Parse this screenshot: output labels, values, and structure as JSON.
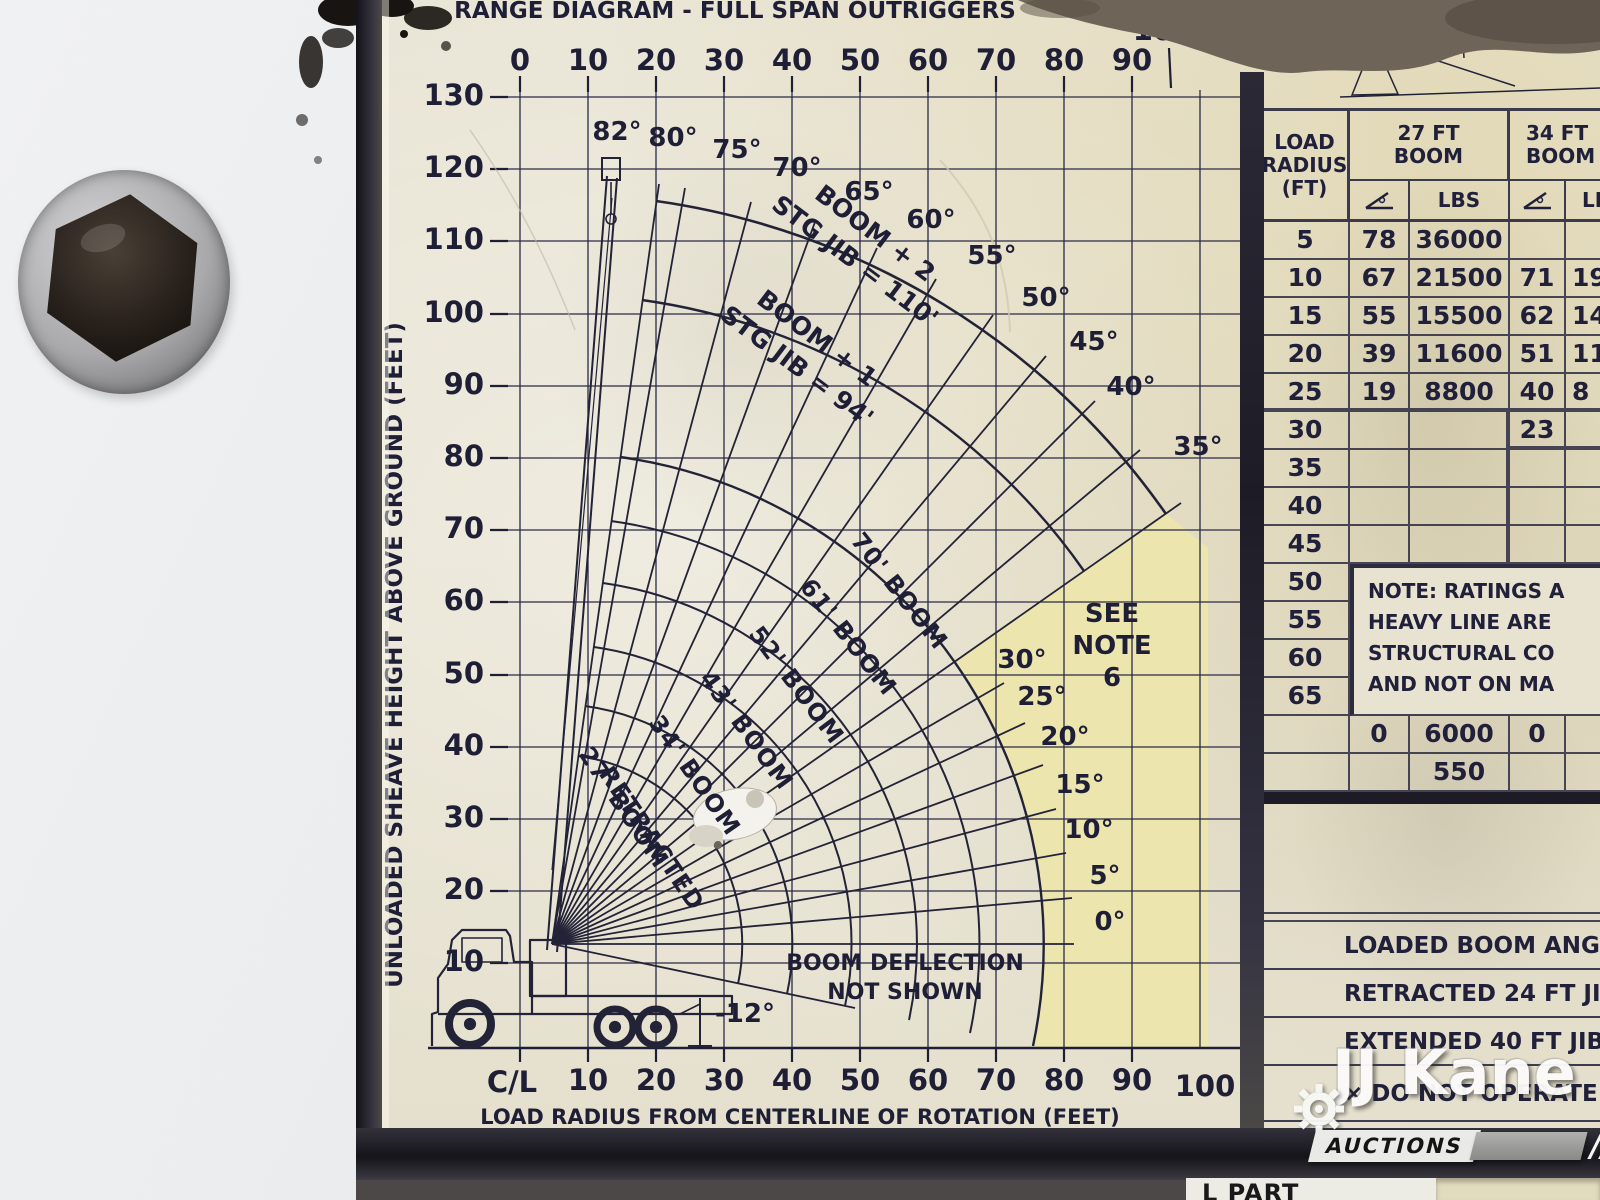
{
  "colors": {
    "placard": "#eae6d7",
    "note_region_yellow": "#ece6ae",
    "ink": "#232338",
    "frame_dark": "#25242e",
    "shadow_band": "#6e6457",
    "truck_body_white": "#f0f1f3"
  },
  "diagram": {
    "title": "RANGE DIAGRAM - FULL SPAN OUTRIGGERS",
    "top_axis_ticks": [
      "0",
      "10",
      "20",
      "30",
      "40",
      "50",
      "60",
      "70",
      "80",
      "90"
    ],
    "top_axis_extra": "100",
    "left_axis_label": "UNLOADED SHEAVE HEIGHT ABOVE GROUND (FEET)",
    "left_axis_ticks": [
      "130",
      "120",
      "110",
      "100",
      "90",
      "80",
      "70",
      "60",
      "50",
      "40",
      "30",
      "20",
      "10"
    ],
    "bottom_axis_ticks": [
      "C/L",
      "10",
      "20",
      "30",
      "40",
      "50",
      "60",
      "70",
      "80",
      "90",
      "100"
    ],
    "bottom_axis_label": "LOAD RADIUS FROM CENTERLINE OF ROTATION (FEET)",
    "outer_angle_labels": [
      "82°",
      "80°",
      "75°",
      "70°",
      "65°",
      "60°",
      "55°",
      "50°",
      "45°",
      "40°",
      "35°"
    ],
    "inner_angle_labels": [
      "30°",
      "25°",
      "20°",
      "15°",
      "10°",
      "5°",
      "0°"
    ],
    "negative_angle_label": "-12°",
    "jib2_line1": "BOOM + 2",
    "jib2_line2": "STG JIB = 110'",
    "jib1_line1": "BOOM + 1",
    "jib1_line2": "STG JIB = 94'",
    "boom_70": "70' BOOM",
    "boom_61": "61' BOOM",
    "boom_52": "52' BOOM",
    "boom_43": "43' BOOM",
    "boom_34": "34' BOOM",
    "boom_27_line1": "27' BOOM",
    "boom_27_line2": "RETRACTED",
    "see_note_line1": "SEE",
    "see_note_line2": "NOTE",
    "see_note_line3": "6",
    "deflection_line1": "BOOM DEFLECTION",
    "deflection_line2": "NOT SHOWN"
  },
  "table": {
    "header": {
      "load_radius_line1": "LOAD",
      "load_radius_line2": "RADIUS",
      "load_radius_line3": "(FT)",
      "boom27_line1": "27 FT",
      "boom27_line2": "BOOM",
      "boom34_line1": "34 FT",
      "boom34_line2": "BOOM",
      "lbs": "LBS"
    },
    "rows": [
      {
        "radius": "5",
        "angle27": "78",
        "lbs27": "36000",
        "angle34": "",
        "lbs34": ""
      },
      {
        "radius": "10",
        "angle27": "67",
        "lbs27": "21500",
        "angle34": "71",
        "lbs34": "195"
      },
      {
        "radius": "15",
        "angle27": "55",
        "lbs27": "15500",
        "angle34": "62",
        "lbs34": "147"
      },
      {
        "radius": "20",
        "angle27": "39",
        "lbs27": "11600",
        "angle34": "51",
        "lbs34": "112"
      },
      {
        "radius": "25",
        "angle27": "19",
        "lbs27": "8800",
        "angle34": "40",
        "lbs34": "8"
      },
      {
        "radius": "30",
        "angle27": "",
        "lbs27": "",
        "angle34": "23",
        "lbs34": ""
      },
      {
        "radius": "35",
        "angle27": "",
        "lbs27": "",
        "angle34": "",
        "lbs34": ""
      },
      {
        "radius": "40",
        "angle27": "",
        "lbs27": "",
        "angle34": "",
        "lbs34": ""
      },
      {
        "radius": "45",
        "angle27": "",
        "lbs27": "",
        "angle34": "",
        "lbs34": ""
      },
      {
        "radius": "50",
        "angle27": "",
        "lbs27": "",
        "angle34": "",
        "lbs34": ""
      },
      {
        "radius": "55",
        "angle27": "",
        "lbs27": "",
        "angle34": "",
        "lbs34": ""
      },
      {
        "radius": "60",
        "angle27": "",
        "lbs27": "",
        "angle34": "",
        "lbs34": ""
      },
      {
        "radius": "65",
        "angle27": "",
        "lbs27": "",
        "angle34": "",
        "lbs34": ""
      }
    ],
    "note_line1": "NOTE: RATINGS A",
    "note_line2": "HEAVY LINE ARE",
    "note_line3": "STRUCTURAL CO",
    "note_line4": "AND NOT ON MA",
    "zero_row": {
      "angle27": "0",
      "lbs27": "6000",
      "angle34": "0"
    },
    "aux_row_lbs27": "550",
    "footer_rows": [
      "LOADED BOOM ANGLE",
      "RETRACTED 24 FT JIB",
      "EXTENDED 40 FT JIB",
      "× DO NOT OPERATE"
    ],
    "bottom_partial": "L PART"
  },
  "watermark": {
    "brand": "JJ Kane",
    "subtitle": "AUCTIONS",
    "slashes": "//"
  },
  "icons": {
    "angle_header": "boom-angle-icon",
    "watermark_gear": "gear-icon"
  }
}
